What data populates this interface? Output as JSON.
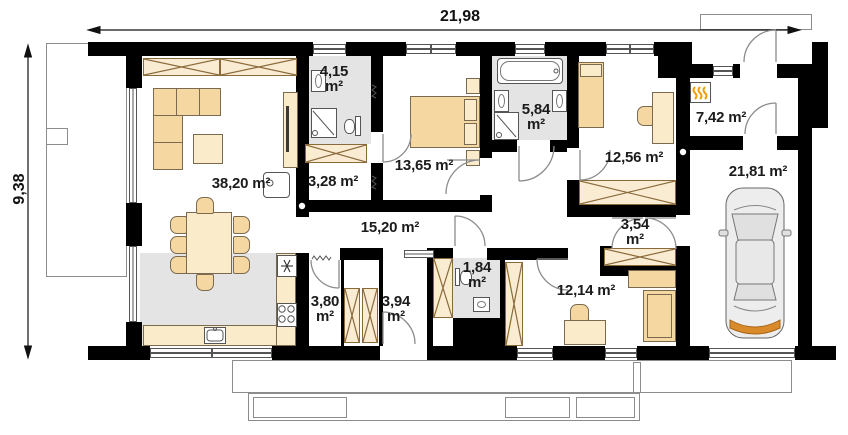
{
  "dimensions": {
    "top": "21,98",
    "left": "9,38"
  },
  "rooms": {
    "living": {
      "area": "38,20 m²"
    },
    "bath_small": {
      "l1": "4,15",
      "l2": "m²"
    },
    "closet": {
      "area": "3,28 m²"
    },
    "bedroom1": {
      "area": "13,65 m²"
    },
    "bath_large": {
      "l1": "5,84",
      "l2": "m²"
    },
    "bedroom2": {
      "area": "12,56 m²"
    },
    "vestibule": {
      "area": "7,42 m²"
    },
    "garage": {
      "area": "21,81 m²"
    },
    "hall": {
      "area": "15,20 m²"
    },
    "corridor": {
      "l1": "3,54",
      "l2": "m²"
    },
    "wc": {
      "l1": "1,84",
      "l2": "m²"
    },
    "pantry": {
      "l1": "3,80",
      "l2": "m²"
    },
    "entry": {
      "l1": "3,94",
      "l2": "m²"
    },
    "bedroom3": {
      "area": "12,14 m²"
    }
  },
  "icons": {
    "heater": "gas-heater-flames",
    "fridge": "snowflake",
    "stove": "four-burners",
    "car": "car-top-view"
  },
  "colors": {
    "wall": "#000000",
    "furniture": "#f5d7a1",
    "furniture_light": "#faecca",
    "floor_gray": "#e4e4e4",
    "outline": "#8c8c8c",
    "flame": "#f09e00",
    "car_accent": "#d98a2b"
  }
}
